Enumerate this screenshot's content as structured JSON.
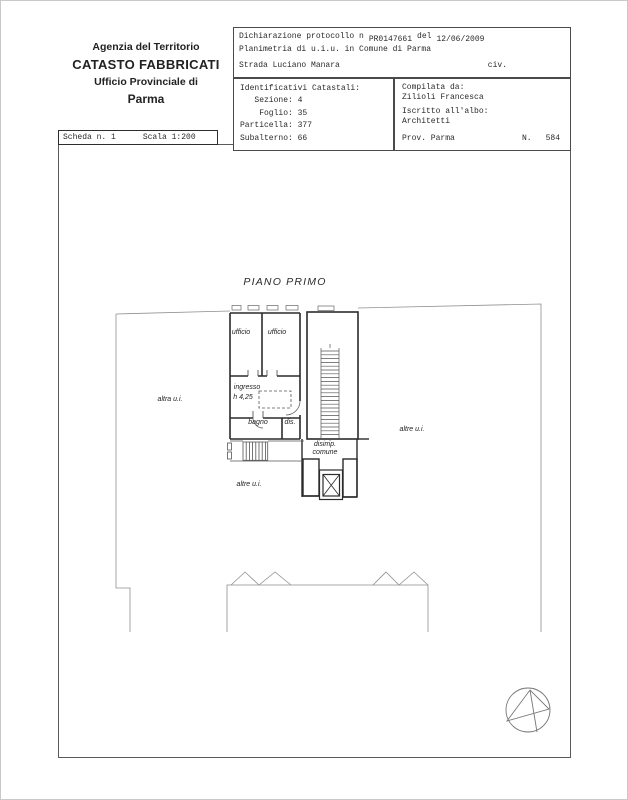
{
  "agency": {
    "line1": "Agenzia del Territorio",
    "line2": "CATASTO FABBRICATI",
    "line3": "Ufficio Provinciale di",
    "line4": "Parma"
  },
  "declaration": {
    "protocol_label": "Dichiarazione protocollo n",
    "protocol_number": "PR0147661",
    "del_label": "del",
    "date": "12/06/2009",
    "planimetria": "Planimetria di u.i.u. in Comune di Parma",
    "street": "Strada Luciano Manara",
    "civ": "civ."
  },
  "cadastral": {
    "lines": [
      "Identificativi Catastali:",
      "   Sezione: 4",
      "    Foglio: 35",
      "Particella: 377",
      "Subalterno: 66"
    ]
  },
  "compiler": {
    "label": "Compilata da:",
    "name": "Zilioli Francesca",
    "albo_label": "Iscritto all'albo:",
    "albo": "Architetti",
    "prov": "Prov. Parma",
    "n_label": "N.",
    "n_value": "584"
  },
  "sheet": {
    "scheda": "Scheda n. 1",
    "scala": "Scala 1:200"
  },
  "plan": {
    "title": "PIANO PRIMO",
    "labels": {
      "ufficio_1": "ufficio",
      "ufficio_2": "ufficio",
      "ingresso": "ingresso",
      "height": "h 4,25",
      "bagno": "bagno",
      "dis": "dis.",
      "disimp_1": "disimp.",
      "disimp_2": "comune",
      "altra_left": "altra u.i.",
      "altre_right": "altre u.i.",
      "altre_bottom": "altre u.i."
    }
  },
  "colors": {
    "wall": "#2b2b2b",
    "boundary": "#8f8f8f",
    "detail": "#555555",
    "border": "#4a4a4a"
  }
}
